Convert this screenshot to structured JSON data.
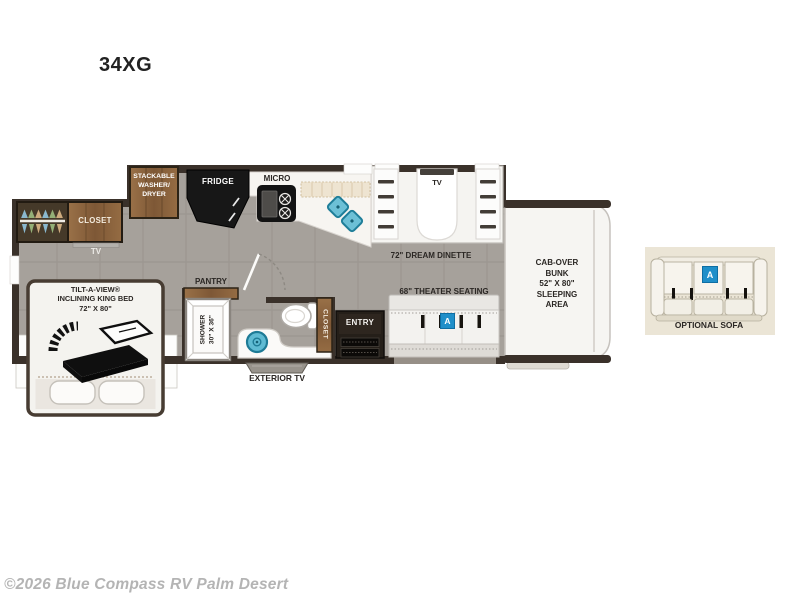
{
  "title": "34XG",
  "footer": {
    "copyright": "©2026 Blue Compass RV Palm Desert"
  },
  "colors": {
    "wall": "#3a312a",
    "floor": "#a6a19b",
    "wood": "#8d6946",
    "counter": "#f7f5f1",
    "accent_blue": "#1f8fc9",
    "sink_teal": "#5fbbd3",
    "sofa_cream_bg": "#ebe5d6",
    "label_dark": "#2b2724",
    "copyright_gray": "#b4b4b4"
  },
  "icons": {
    "bed": "incline-bed-icon",
    "toilet": "toilet-icon",
    "kitchen_sink": "double-basin-sink-icon",
    "bath_sink": "round-basin-sink-icon",
    "wardrobe": "hanger-rack-icon",
    "stove": "cooktop-icon"
  },
  "floorplan": {
    "rear": {
      "closet": "CLOSET",
      "tv": "TV"
    },
    "bedroom": {
      "bed": "TILT-A-VIEW®\nINCLINING KING BED\n72\" X 80\""
    },
    "kitchen": {
      "washer_dryer": "STACKABLE\nWASHER/\nDRYER",
      "fridge": "FRIDGE",
      "micro": "MICRO",
      "pantry": "PANTRY"
    },
    "bath": {
      "shower": "SHOWER\n30\" X 36\"",
      "closet": "CLOSET"
    },
    "living": {
      "dinette_tv": "TV",
      "dinette": "72\" DREAM DINETTE",
      "theater": "68\" THEATER SEATING",
      "entry": "ENTRY",
      "theater_badge": "A"
    },
    "front": {
      "cab_over_bunk": "CAB-OVER\nBUNK\n52\" X 80\"\nSLEEPING\nAREA"
    },
    "exterior": {
      "exterior_tv": "EXTERIOR TV"
    },
    "optional_sofa": {
      "label": "OPTIONAL SOFA",
      "badge": "A"
    }
  }
}
